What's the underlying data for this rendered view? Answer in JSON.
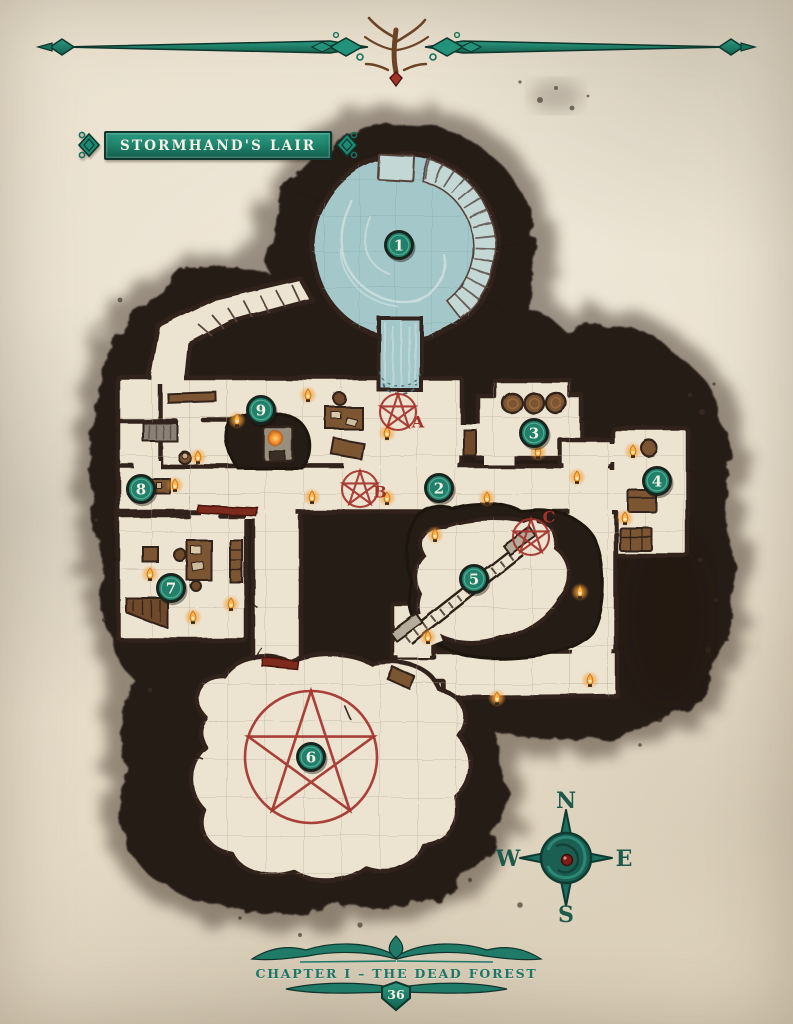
{
  "header": {
    "title": "STORMHAND'S LAIR"
  },
  "footer": {
    "chapter": "CHAPTER I – THE DEAD FOREST",
    "page_number": "36"
  },
  "compass": {
    "north": "N",
    "east": "E",
    "south": "S",
    "west": "W"
  },
  "map": {
    "markers": [
      {
        "id": "1",
        "x": 399,
        "y": 245
      },
      {
        "id": "2",
        "x": 439,
        "y": 488
      },
      {
        "id": "3",
        "x": 534,
        "y": 433
      },
      {
        "id": "4",
        "x": 657,
        "y": 481
      },
      {
        "id": "5",
        "x": 474,
        "y": 579
      },
      {
        "id": "6",
        "x": 311,
        "y": 757
      },
      {
        "id": "7",
        "x": 171,
        "y": 588
      },
      {
        "id": "8",
        "x": 141,
        "y": 489
      },
      {
        "id": "9",
        "x": 261,
        "y": 410
      }
    ],
    "ritual_circles": [
      {
        "id": "A",
        "x": 398,
        "y": 412,
        "r": 18,
        "label_dx": 20,
        "label_dy": 10
      },
      {
        "id": "B",
        "x": 360,
        "y": 489,
        "r": 18,
        "label_dx": 20,
        "label_dy": 3
      },
      {
        "id": "C",
        "x": 531,
        "y": 537,
        "r": 18,
        "label_dx": 18,
        "label_dy": -20
      },
      {
        "id": "",
        "x": 311,
        "y": 757,
        "r": 66,
        "label_dx": 0,
        "label_dy": 0
      }
    ],
    "torches": [
      [
        308,
        395
      ],
      [
        237,
        420
      ],
      [
        198,
        457
      ],
      [
        175,
        485
      ],
      [
        312,
        497
      ],
      [
        387,
        433
      ],
      [
        387,
        498
      ],
      [
        538,
        452
      ],
      [
        577,
        477
      ],
      [
        633,
        451
      ],
      [
        487,
        498
      ],
      [
        625,
        518
      ],
      [
        150,
        574
      ],
      [
        231,
        604
      ],
      [
        193,
        617
      ],
      [
        435,
        535
      ],
      [
        580,
        592
      ],
      [
        428,
        637
      ],
      [
        497,
        698
      ],
      [
        590,
        680
      ]
    ]
  },
  "colors": {
    "parchment": "#e8dfcc",
    "cave_dark": "#261d16",
    "room_floor": "#ece3d0",
    "wall_stroke": "#33211a",
    "water": "#a4c7c9",
    "stairs": "#c3d8d4",
    "grid_line": "#b3a795",
    "marker_fill": "#20806a",
    "marker_rim": "#19241f",
    "marker_text": "#f2efe4",
    "ritual_red": "#a3322b",
    "flame_orange": "#f6a13a",
    "banner_teal": "#1e8a74",
    "compass_teal": "#1c6f60",
    "text_light": "#f4f1e6"
  }
}
